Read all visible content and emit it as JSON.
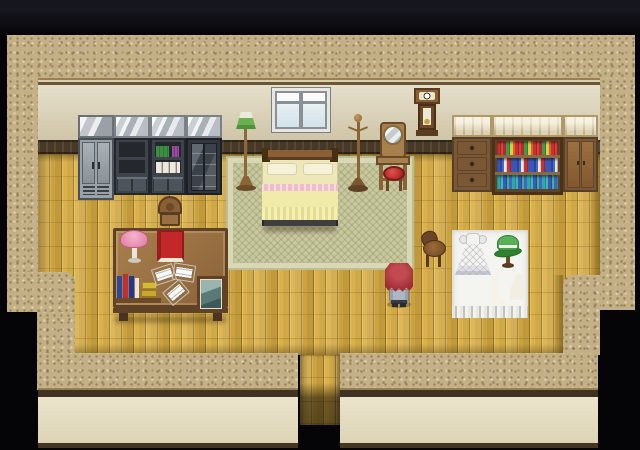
{
  "meta": {
    "type": "game-screenshot",
    "scene": "Top-down RPG interior: bedroom-study with wooden floor, bed on green rug, shelves, desk and sewing corner",
    "width": 640,
    "height": 450
  },
  "palette": {
    "void-top": "#16161e",
    "black": "#050507",
    "wall-base": "#c3b086",
    "inner-top": "#e6dfca",
    "inner-bottom": "#cfc6a8",
    "trim-light": "#9a7f55",
    "trim-dark": "#6b5638",
    "wainscot": "#483826",
    "floor-base": "#d9ae44",
    "floor-light": "#e5c05c",
    "floor-edge": "#9c7a2e",
    "rug-base": "#c9c9a0",
    "rug-border": "#d8d8b4",
    "lower-face": "#ebe4cb",
    "rail-dark": "#3f3222",
    "wood-dark": "#5a3c22",
    "wood-mid": "#8a6238",
    "wood-light": "#a8804e",
    "woodtop-light": "#eee3c2",
    "metal-mid": "#9aa2a8",
    "shelf-dark": "#3e444a",
    "cavity": "#24282c",
    "bed-blanket": "#f0eba8",
    "bed-pink": "#f2bcca",
    "bed-pillow": "#f6f2da",
    "lamp-green": "#64a84c",
    "lamp-pink": "#ec9cba",
    "book-red": "#c22828",
    "hat-green": "#3f9a3f",
    "mat-white": "#f4f4f0",
    "hair-red": "#a13238",
    "outfit-gray": "#aeb6c4"
  },
  "scene": {
    "objects": [
      {
        "id": "locker",
        "label": "metal locker"
      },
      {
        "id": "shelf-empty",
        "label": "dark storage shelf"
      },
      {
        "id": "shelf-books",
        "label": "shelf with books and binders"
      },
      {
        "id": "display-cabinet",
        "label": "glass display cabinet"
      },
      {
        "id": "window",
        "label": "window"
      },
      {
        "id": "wall-clock",
        "label": "pendulum wall clock"
      },
      {
        "id": "floor-lamp",
        "label": "green floor lamp"
      },
      {
        "id": "bed",
        "label": "bed with yellow blanket and pink trim"
      },
      {
        "id": "coat-stand",
        "label": "wooden coat stand"
      },
      {
        "id": "vanity",
        "label": "vanity with round mirror"
      },
      {
        "id": "stool-red",
        "label": "red stool"
      },
      {
        "id": "dresser",
        "label": "wooden dresser with drawers"
      },
      {
        "id": "bookshelf",
        "label": "bookshelf with colorful books"
      },
      {
        "id": "cabinet",
        "label": "wooden cabinet"
      },
      {
        "id": "desk-chair",
        "label": "wooden desk chair"
      },
      {
        "id": "desk",
        "label": "writing desk with lamp, book, papers and photo"
      },
      {
        "id": "desk-lamp",
        "label": "pink desk lamp"
      },
      {
        "id": "red-book",
        "label": "red book"
      },
      {
        "id": "papers",
        "label": "scattered papers"
      },
      {
        "id": "photo",
        "label": "framed picture"
      },
      {
        "id": "sewing-mat",
        "label": "white cloth mat with fringe"
      },
      {
        "id": "dress",
        "label": "white ruffled dress"
      },
      {
        "id": "green-hat",
        "label": "green hat on stand"
      },
      {
        "id": "pattern-tools",
        "label": "sewing pattern pieces"
      },
      {
        "id": "stool-wood",
        "label": "wooden stool"
      },
      {
        "id": "player",
        "label": "player character with long red hair"
      },
      {
        "id": "doorway",
        "label": "doorway exit at bottom"
      }
    ]
  }
}
